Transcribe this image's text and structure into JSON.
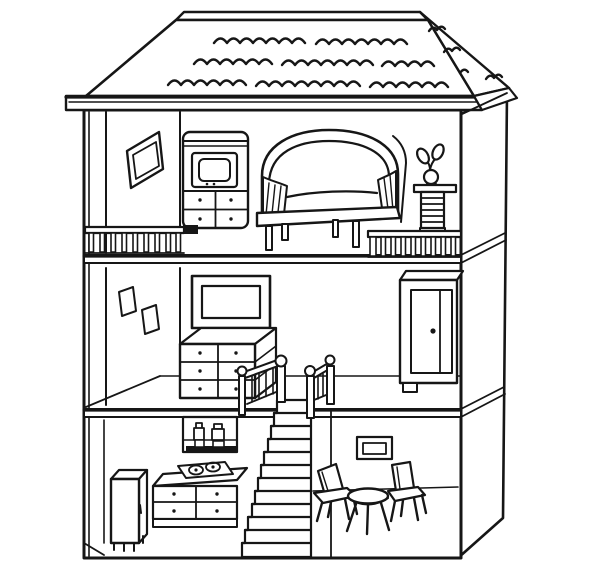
{
  "canvas": {
    "width": 600,
    "height": 585
  },
  "colors": {
    "background": "#ffffff",
    "ink": "#161616"
  },
  "scene": {
    "subject": "Three-story dollhouse cutaway line drawing",
    "style": "black outline coloring-book illustration",
    "roof": {
      "style": "hipped roof with scalloped shingle waves",
      "shingle_rows": 3
    },
    "floors": [
      {
        "name": "top floor",
        "objects": [
          "tilted-window-frame",
          "tv-cabinet-with-drawers",
          "canopy-sofa",
          "potted-plant-on-pedestal",
          "balcony-railing-left",
          "balcony-railing-right"
        ]
      },
      {
        "name": "middle floor",
        "objects": [
          "two-small-wall-frames",
          "television-on-dresser",
          "stairwell-railings-with-ball-posts",
          "wardrobe-with-door-knob"
        ]
      },
      {
        "name": "ground floor",
        "objects": [
          "refrigerator",
          "wall-shelf-with-jars",
          "stove-counter-with-drawers",
          "staircase",
          "small-picture-frame",
          "chair-left",
          "round-stool-table",
          "chair-right"
        ]
      }
    ]
  }
}
